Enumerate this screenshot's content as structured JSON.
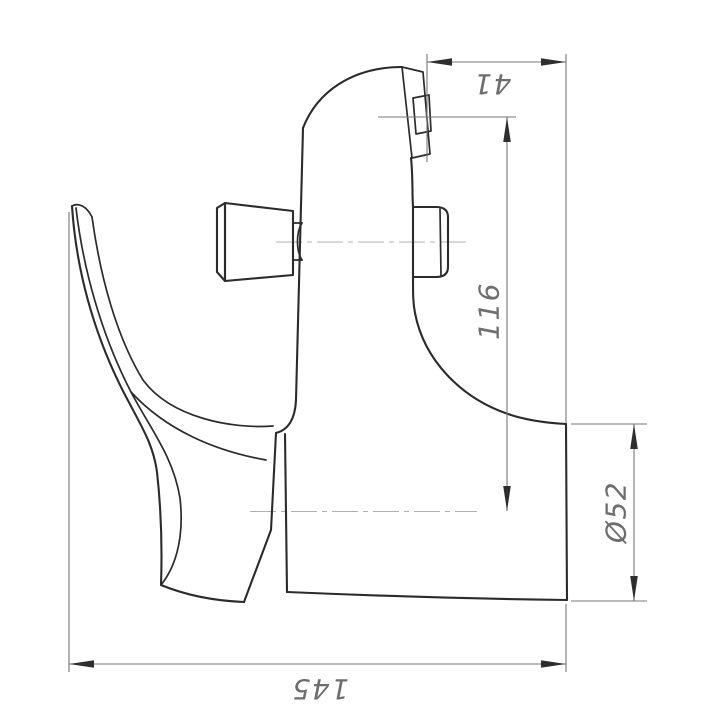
{
  "drawing": {
    "background_color": "#ffffff",
    "outline_color": "#2b2b2b",
    "dimension_line_color": "#777777",
    "centerline_color": "#b0b0b0",
    "arrow_color": "#2e2e2e",
    "dimension_text_color": "#6e6e6e",
    "dimensions": [
      {
        "id": "dim-41",
        "label": "41"
      },
      {
        "id": "dim-116",
        "label": "116"
      },
      {
        "id": "dim-52",
        "label": "Ø52"
      },
      {
        "id": "dim-145",
        "label": "145"
      }
    ]
  }
}
